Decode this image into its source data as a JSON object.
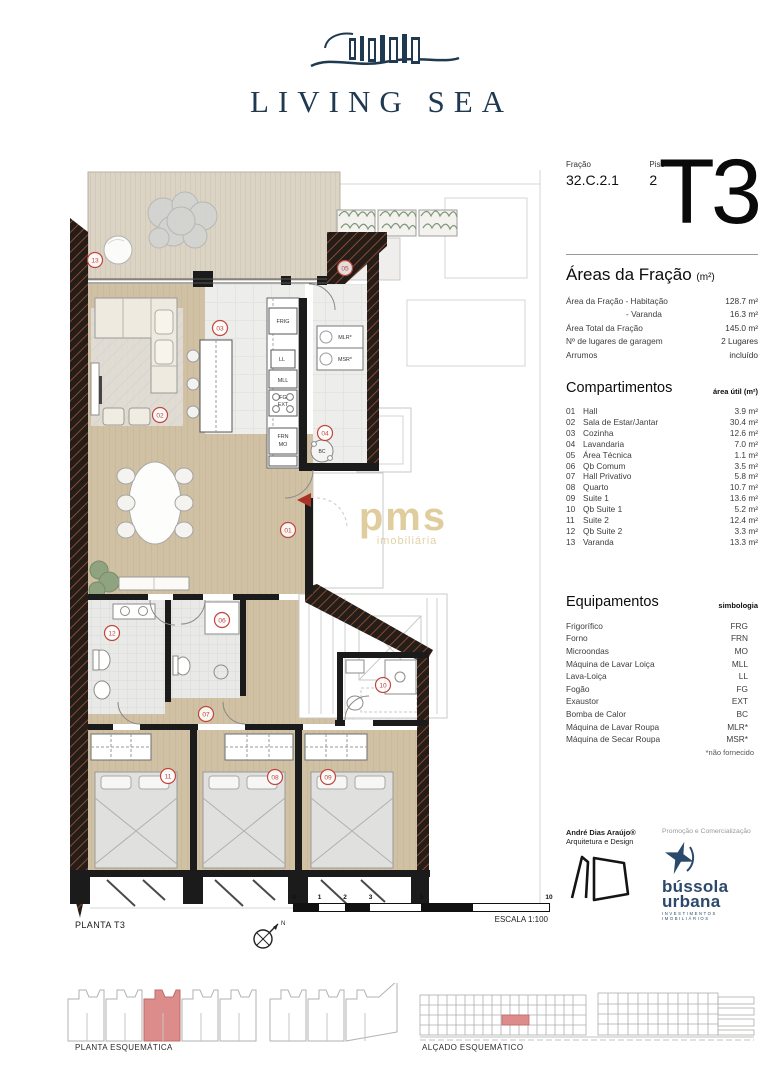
{
  "brand": {
    "name": "LIVING SEA"
  },
  "header": {
    "fracao_label": "Fração",
    "fracao_value": "32.C.2.1",
    "piso_label": "Piso",
    "piso_value": "2",
    "typology": "T3"
  },
  "areas": {
    "title": "Áreas da Fração",
    "unit": "(m²)",
    "rows": [
      [
        "Área da Fração - Habitação",
        "128.7 m²"
      ],
      [
        "- Varanda",
        "16.3 m²"
      ],
      [
        "Área Total da Fração",
        "145.0 m²"
      ],
      [
        "Nº de lugares de garagem",
        "2 Lugares"
      ],
      [
        "Arrumos",
        "incluído"
      ]
    ]
  },
  "compartimentos": {
    "title": "Compartimentos",
    "col_header": "área útil (m²)",
    "rows": [
      [
        "01",
        "Hall",
        "3.9 m²"
      ],
      [
        "02",
        "Sala de Estar/Jantar",
        "30.4 m²"
      ],
      [
        "03",
        "Cozinha",
        "12.6 m²"
      ],
      [
        "04",
        "Lavandaria",
        "7.0 m²"
      ],
      [
        "05",
        "Área Técnica",
        "1.1 m²"
      ],
      [
        "06",
        "Qb Comum",
        "3.5 m²"
      ],
      [
        "07",
        "Hall Privativo",
        "5.8 m²"
      ],
      [
        "08",
        "Quarto",
        "10.7 m²"
      ],
      [
        "09",
        "Suite 1",
        "13.6 m²"
      ],
      [
        "10",
        "Qb Suite 1",
        "5.2 m²"
      ],
      [
        "11",
        "Suite 2",
        "12.4 m²"
      ],
      [
        "12",
        "Qb Suite 2",
        "3.3 m²"
      ],
      [
        "13",
        "Varanda",
        "13.3 m²"
      ]
    ]
  },
  "equipamentos": {
    "title": "Equipamentos",
    "col_header": "simbologia",
    "rows": [
      [
        "Frigorífico",
        "FRG"
      ],
      [
        "Forno",
        "FRN"
      ],
      [
        "Microondas",
        "MO"
      ],
      [
        "Máquina de Lavar Loiça",
        "MLL"
      ],
      [
        "Lava-Loiça",
        "LL"
      ],
      [
        "Fogão",
        "FG"
      ],
      [
        "Exaustor",
        "EXT"
      ],
      [
        "Bomba de Calor",
        "BC"
      ],
      [
        "Máquina de Lavar Roupa",
        "MLR*"
      ],
      [
        "Máquina de Secar Roupa",
        "MSR*"
      ]
    ],
    "footnote": "*não fornecido"
  },
  "credits": {
    "architect_name": "André Dias Araújo®",
    "architect_sub": "Arquitetura e Design",
    "promo_label": "Promoção e Comercialização",
    "promo_name_1": "bússola",
    "promo_name_2": "urbana",
    "promo_sub": "INVESTIMENTOS IMOBILIÁRIOS"
  },
  "plan": {
    "caption": "PLANTA T3",
    "scale_caption": "ESCALA 1:100",
    "scale_ticks": [
      "0",
      "1",
      "2",
      "3",
      "5",
      "10"
    ],
    "north_label": "N",
    "room_numbers": [
      "01",
      "02",
      "03",
      "04",
      "05",
      "06",
      "07",
      "08",
      "09",
      "10",
      "11",
      "12",
      "13"
    ],
    "equipment_tags": {
      "frig": "FRIG",
      "ll": "LL",
      "mll": "MLL",
      "fg": "FG",
      "ext": "EXT",
      "frn": "FRN",
      "mo": "MO",
      "mlr": "MLR*",
      "msr": "MSR*",
      "bc": "BC"
    },
    "watermark_line1": "pms",
    "watermark_line2": "imobiliária"
  },
  "footer": {
    "schematic_caption": "PLANTA ESQUEMÁTICA",
    "elevation_caption": "ALÇADO ESQUEMÁTICO"
  },
  "colors": {
    "navy": "#1e3950",
    "red_marker": "#c2463d",
    "gold": "#c7a559",
    "highlight": "#dd8c8c",
    "promo_navy": "#2b4a6b"
  }
}
